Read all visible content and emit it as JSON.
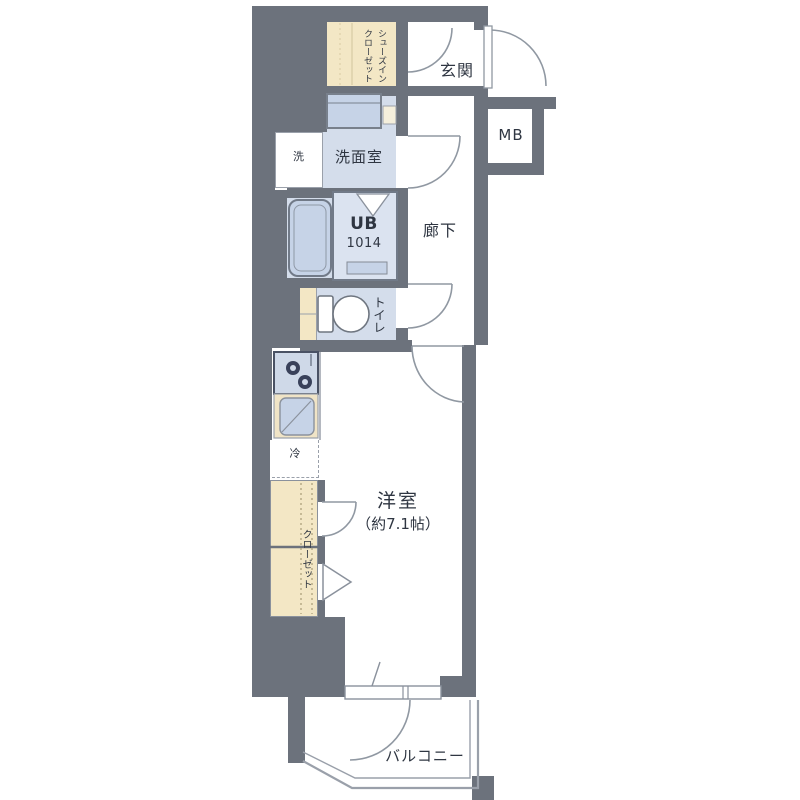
{
  "floorplan": {
    "rooms": {
      "shoe_closet": {
        "label_line1": "シューズイン",
        "label_line2": "クローゼット"
      },
      "entrance": {
        "label": "玄関"
      },
      "meter_box": {
        "label": "MB"
      },
      "washroom": {
        "label": "洗面室",
        "washer_spot_label": "洗"
      },
      "unit_bath": {
        "label_line1": "UB",
        "label_line2": "1014"
      },
      "toilet": {
        "label": "トイレ"
      },
      "hallway": {
        "label": "廊下"
      },
      "kitchen": {
        "refrigerator_label": "冷"
      },
      "closet": {
        "label": "クローゼット"
      },
      "western_room": {
        "label_line1": "洋室",
        "label_line2": "（約7.1帖）"
      },
      "balcony": {
        "label": "バルコニー"
      }
    },
    "colors": {
      "wall": "#6c727c",
      "storage_beige": "#f3e7c5",
      "wet_area_blue": "#d4ddeb",
      "fixture_blue": "#c6d3e7",
      "outline_gray": "#939aa5",
      "text": "#2f3642"
    }
  }
}
